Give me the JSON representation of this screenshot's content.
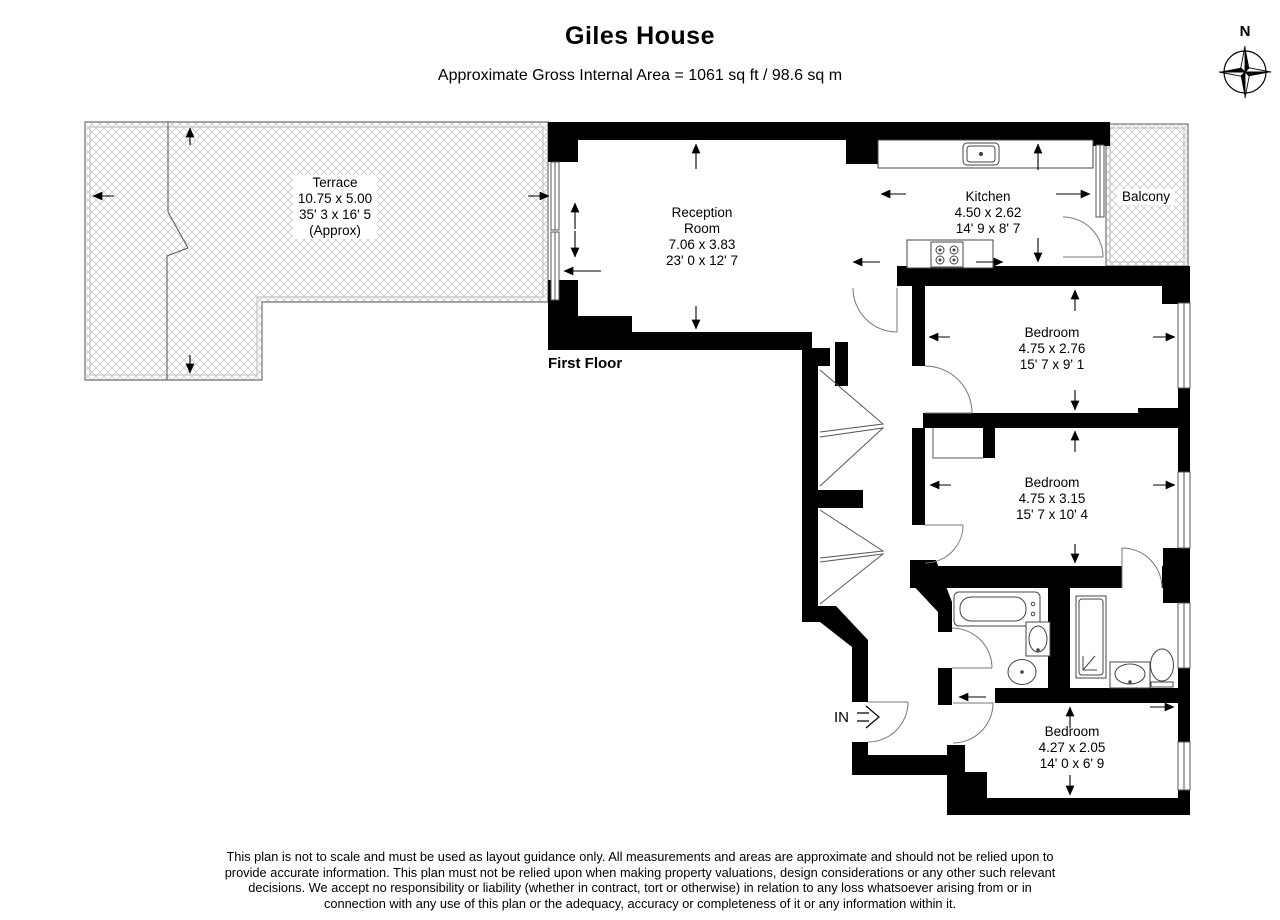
{
  "header": {
    "title": "Giles House",
    "subtitle": "Approximate Gross Internal Area = 1061 sq ft / 98.6 sq m"
  },
  "compass": {
    "north_label": "N"
  },
  "plan": {
    "floor_label": "First Floor",
    "entrance_label": "IN",
    "rooms": {
      "terrace": {
        "lines": [
          "Terrace",
          "10.75 x 5.00",
          "35' 3 x 16' 5",
          "(Approx)"
        ]
      },
      "reception": {
        "lines": [
          "Reception",
          "Room",
          "7.06 x 3.83",
          "23' 0 x 12' 7"
        ]
      },
      "kitchen": {
        "lines": [
          "Kitchen",
          "4.50 x 2.62",
          "14' 9 x 8' 7"
        ]
      },
      "balcony": {
        "lines": [
          "Balcony"
        ]
      },
      "bedroom1": {
        "lines": [
          "Bedroom",
          "4.75 x 2.76",
          "15' 7 x 9' 1"
        ]
      },
      "bedroom2": {
        "lines": [
          "Bedroom",
          "4.75 x 3.15",
          "15' 7 x 10' 4"
        ]
      },
      "bedroom3": {
        "lines": [
          "Bedroom",
          "4.27 x 2.05",
          "14' 0 x 6' 9"
        ]
      }
    }
  },
  "footer": {
    "lines": [
      "This plan is not to scale and must be used as layout guidance only. All measurements and areas are approximate and should not be relied upon to",
      "provide accurate information. This plan must not be relied upon when making property valuations, design considerations or any other such relevant",
      "decisions. We accept no responsibility or liability (whether in contract, tort or otherwise) in relation to any loss whatsoever arising from or in",
      "connection with any use of this plan or the adequacy, accuracy or completeness of it or any information within it."
    ]
  },
  "colors": {
    "wall": "#000000",
    "hatch": "#c8c8c8",
    "outline": "#888888",
    "fixture": "#444444",
    "text": "#000000",
    "background": "#ffffff"
  }
}
